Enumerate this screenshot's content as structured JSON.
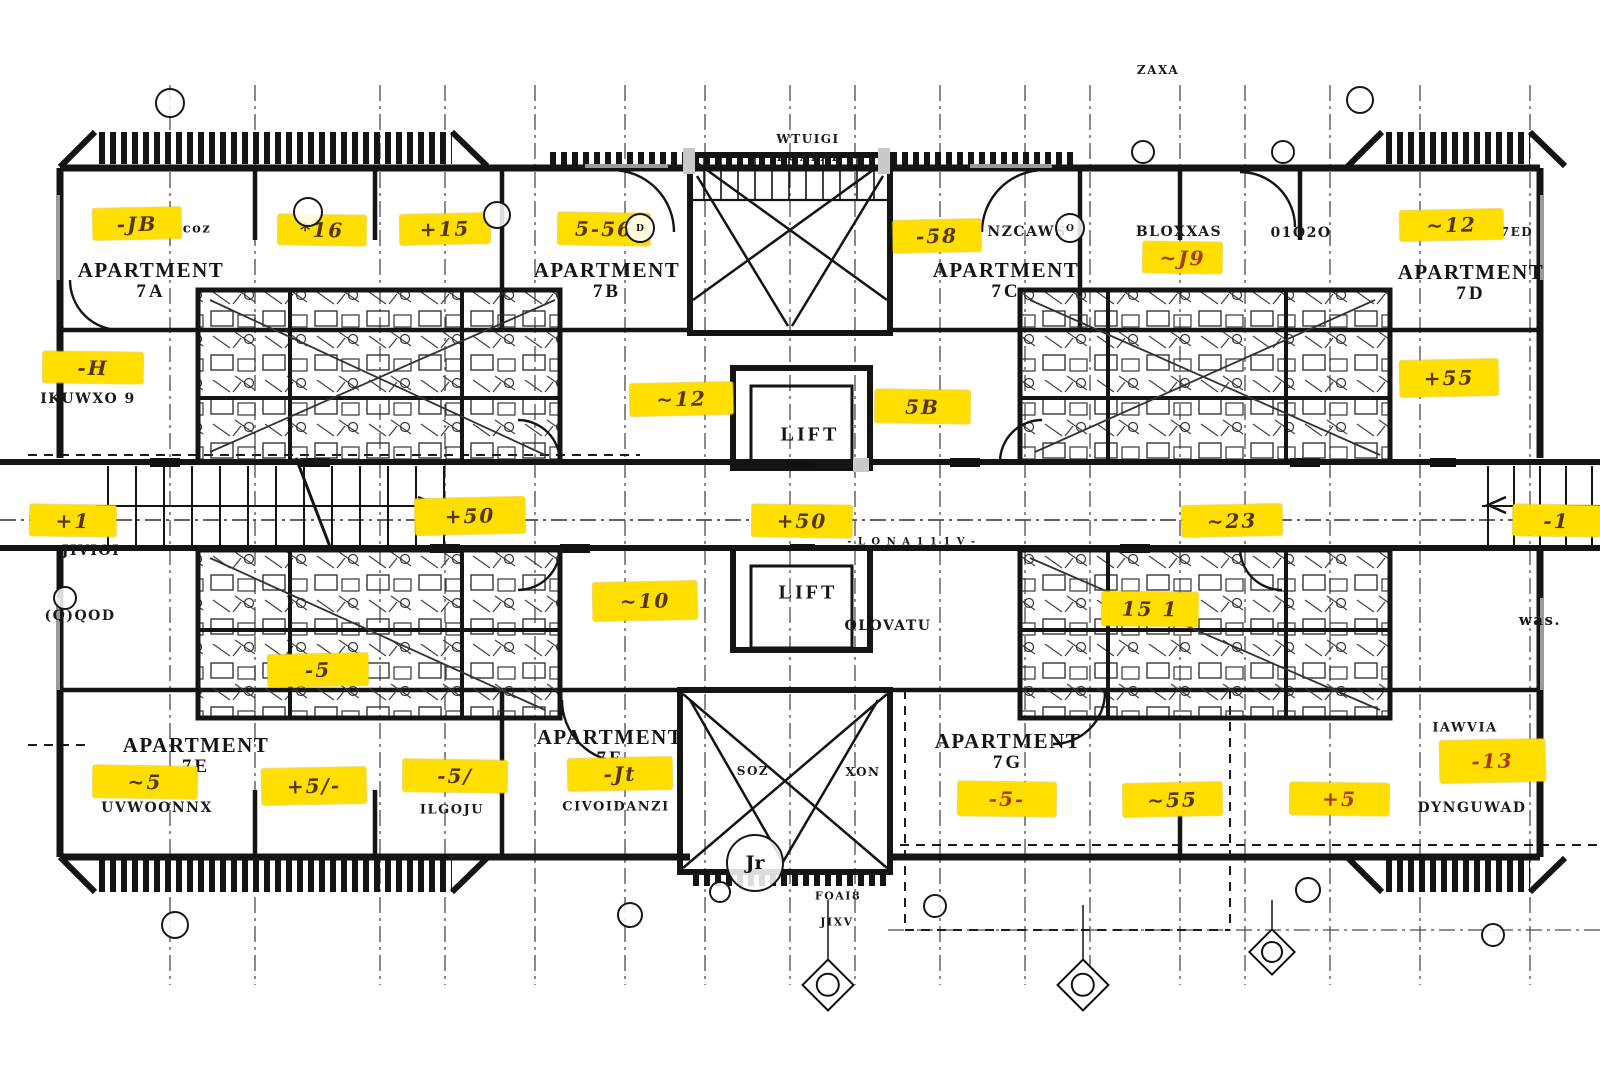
{
  "meta": {
    "drawing_type": "apartment floor plan with highlighted markup"
  },
  "colors": {
    "paper": "#FFFFFF",
    "wall_ink": "#141414",
    "highlight": "#FFDE00",
    "tag_ink": "#54360a",
    "tag_ink_red": "#a83c00"
  },
  "apartments": [
    {
      "label": "APARTMENT",
      "unit": "7A",
      "x": 151,
      "y": 281
    },
    {
      "label": "APARTMENT",
      "unit": "7B",
      "x": 607,
      "y": 281
    },
    {
      "label": "APARTMENT",
      "unit": "7C",
      "x": 1006,
      "y": 281
    },
    {
      "label": "APARTMENT",
      "unit": "7D",
      "x": 1471,
      "y": 283
    },
    {
      "label": "APARTMENT",
      "unit": "7E",
      "x": 196,
      "y": 756
    },
    {
      "label": "APARTMENT",
      "unit": "7F",
      "x": 610,
      "y": 748
    },
    {
      "label": "APARTMENT",
      "unit": "7G",
      "x": 1008,
      "y": 752
    }
  ],
  "lifts": [
    {
      "label": "LIFT",
      "x": 810,
      "y": 435
    },
    {
      "label": "LIFT",
      "x": 808,
      "y": 593
    }
  ],
  "tags": [
    {
      "code": "-JB",
      "x": 93,
      "y": 208,
      "w": 88,
      "h": 31,
      "tone": "brown"
    },
    {
      "code": "*16",
      "x": 278,
      "y": 215,
      "w": 88,
      "h": 30,
      "tone": "brown"
    },
    {
      "code": "+15",
      "x": 400,
      "y": 214,
      "w": 90,
      "h": 30,
      "tone": "brown"
    },
    {
      "code": "5-56",
      "x": 558,
      "y": 213,
      "w": 92,
      "h": 32,
      "tone": "brown"
    },
    {
      "code": "-58",
      "x": 893,
      "y": 220,
      "w": 88,
      "h": 32,
      "tone": "brown"
    },
    {
      "code": "~J9",
      "x": 1143,
      "y": 242,
      "w": 79,
      "h": 31,
      "tone": "red"
    },
    {
      "code": "~12",
      "x": 1400,
      "y": 210,
      "w": 103,
      "h": 30,
      "tone": "brown"
    },
    {
      "code": "-H",
      "x": 43,
      "y": 352,
      "w": 100,
      "h": 31,
      "tone": "brown"
    },
    {
      "code": "~12",
      "x": 630,
      "y": 383,
      "w": 103,
      "h": 32,
      "tone": "brown"
    },
    {
      "code": "5B",
      "x": 875,
      "y": 390,
      "w": 95,
      "h": 33,
      "tone": "brown"
    },
    {
      "code": "+55",
      "x": 1400,
      "y": 360,
      "w": 98,
      "h": 36,
      "tone": "brown"
    },
    {
      "code": "+1",
      "x": 30,
      "y": 505,
      "w": 86,
      "h": 31,
      "tone": "brown"
    },
    {
      "code": "+50",
      "x": 415,
      "y": 498,
      "w": 110,
      "h": 36,
      "tone": "brown"
    },
    {
      "code": "+50",
      "x": 752,
      "y": 505,
      "w": 100,
      "h": 32,
      "tone": "brown"
    },
    {
      "code": "~23",
      "x": 1182,
      "y": 505,
      "w": 100,
      "h": 31,
      "tone": "brown"
    },
    {
      "code": "-1",
      "x": 1513,
      "y": 505,
      "w": 87,
      "h": 31,
      "tone": "brown"
    },
    {
      "code": "~10",
      "x": 593,
      "y": 582,
      "w": 104,
      "h": 38,
      "tone": "brown"
    },
    {
      "code": "15 1",
      "x": 1102,
      "y": 592,
      "w": 96,
      "h": 34,
      "tone": "brown"
    },
    {
      "code": "-5",
      "x": 268,
      "y": 654,
      "w": 100,
      "h": 32,
      "tone": "brown"
    },
    {
      "code": "~5",
      "x": 93,
      "y": 766,
      "w": 104,
      "h": 32,
      "tone": "brown"
    },
    {
      "code": "+5/-",
      "x": 262,
      "y": 768,
      "w": 104,
      "h": 36,
      "tone": "brown"
    },
    {
      "code": "-5/",
      "x": 403,
      "y": 760,
      "w": 104,
      "h": 32,
      "tone": "brown"
    },
    {
      "code": "-Jt",
      "x": 568,
      "y": 758,
      "w": 104,
      "h": 32,
      "tone": "brown"
    },
    {
      "code": "-5-",
      "x": 958,
      "y": 782,
      "w": 98,
      "h": 34,
      "tone": "red"
    },
    {
      "code": "~55",
      "x": 1123,
      "y": 783,
      "w": 99,
      "h": 33,
      "tone": "brown"
    },
    {
      "code": "+5",
      "x": 1290,
      "y": 783,
      "w": 99,
      "h": 32,
      "tone": "red"
    },
    {
      "code": "-13",
      "x": 1440,
      "y": 740,
      "w": 105,
      "h": 42,
      "tone": "red"
    }
  ],
  "annotations": [
    {
      "text": "coz",
      "x": 197,
      "y": 229,
      "size": 13
    },
    {
      "text": "ZAXA",
      "x": 1158,
      "y": 70,
      "size": 12
    },
    {
      "text": "WTUIGI",
      "x": 808,
      "y": 139,
      "size": 12
    },
    {
      "text": "ROALAL",
      "x": 809,
      "y": 157,
      "size": 12
    },
    {
      "text": "NZCAWS",
      "x": 1027,
      "y": 232,
      "size": 14
    },
    {
      "text": "BLOXXAS",
      "x": 1179,
      "y": 232,
      "size": 14
    },
    {
      "text": "01O2O",
      "x": 1301,
      "y": 233,
      "size": 14
    },
    {
      "text": "7ED",
      "x": 1517,
      "y": 232,
      "size": 12
    },
    {
      "text": "IKUWXO 9",
      "x": 88,
      "y": 399,
      "size": 14
    },
    {
      "text": "JIVIOI",
      "x": 91,
      "y": 551,
      "size": 14
    },
    {
      "text": "(Q)QOD",
      "x": 80,
      "y": 616,
      "size": 14
    },
    {
      "text": "OLOVATU",
      "x": 888,
      "y": 626,
      "size": 14
    },
    {
      "text": "was.",
      "x": 1540,
      "y": 620,
      "size": 15
    },
    {
      "text": "w el",
      "x": 1175,
      "y": 622,
      "size": 12
    },
    {
      "text": "UVWOONNX",
      "x": 157,
      "y": 808,
      "size": 14
    },
    {
      "text": "ILGOJU",
      "x": 452,
      "y": 810,
      "size": 13
    },
    {
      "text": "CIVOIDANZI",
      "x": 616,
      "y": 807,
      "size": 13
    },
    {
      "text": "SOZ",
      "x": 753,
      "y": 771,
      "size": 12
    },
    {
      "text": "XON",
      "x": 863,
      "y": 772,
      "size": 12
    },
    {
      "text": "FOAI8",
      "x": 838,
      "y": 896,
      "size": 11
    },
    {
      "text": "JIXV",
      "x": 837,
      "y": 922,
      "size": 11
    },
    {
      "text": "IAWVIA",
      "x": 1465,
      "y": 728,
      "size": 13
    },
    {
      "text": "DYNGUWAD",
      "x": 1472,
      "y": 808,
      "size": 14
    },
    {
      "text": "- L O N A 1 1 1 V -",
      "x": 912,
      "y": 542,
      "size": 10
    }
  ],
  "grid_markers": {
    "circles": [
      {
        "x": 170,
        "y": 103,
        "r": 13,
        "label": ""
      },
      {
        "x": 308,
        "y": 212,
        "r": 13,
        "label": ""
      },
      {
        "x": 497,
        "y": 215,
        "r": 12,
        "label": ""
      },
      {
        "x": 640,
        "y": 228,
        "r": 13,
        "label": "D"
      },
      {
        "x": 1070,
        "y": 228,
        "r": 13,
        "label": "O"
      },
      {
        "x": 1143,
        "y": 152,
        "r": 10,
        "label": ""
      },
      {
        "x": 1283,
        "y": 152,
        "r": 10,
        "label": ""
      },
      {
        "x": 1360,
        "y": 100,
        "r": 12,
        "label": ""
      },
      {
        "x": 65,
        "y": 598,
        "r": 10,
        "label": ""
      },
      {
        "x": 175,
        "y": 925,
        "r": 12,
        "label": ""
      },
      {
        "x": 630,
        "y": 915,
        "r": 11,
        "label": ""
      },
      {
        "x": 755,
        "y": 863,
        "r": 27,
        "label": "Jr"
      },
      {
        "x": 720,
        "y": 892,
        "r": 9,
        "label": ""
      },
      {
        "x": 935,
        "y": 906,
        "r": 10,
        "label": ""
      },
      {
        "x": 1308,
        "y": 890,
        "r": 11,
        "label": ""
      },
      {
        "x": 1493,
        "y": 935,
        "r": 10,
        "label": ""
      }
    ],
    "diamonds": [
      {
        "x": 828,
        "y": 985,
        "size": 34
      },
      {
        "x": 1083,
        "y": 985,
        "size": 34
      },
      {
        "x": 1272,
        "y": 952,
        "size": 30
      }
    ]
  }
}
